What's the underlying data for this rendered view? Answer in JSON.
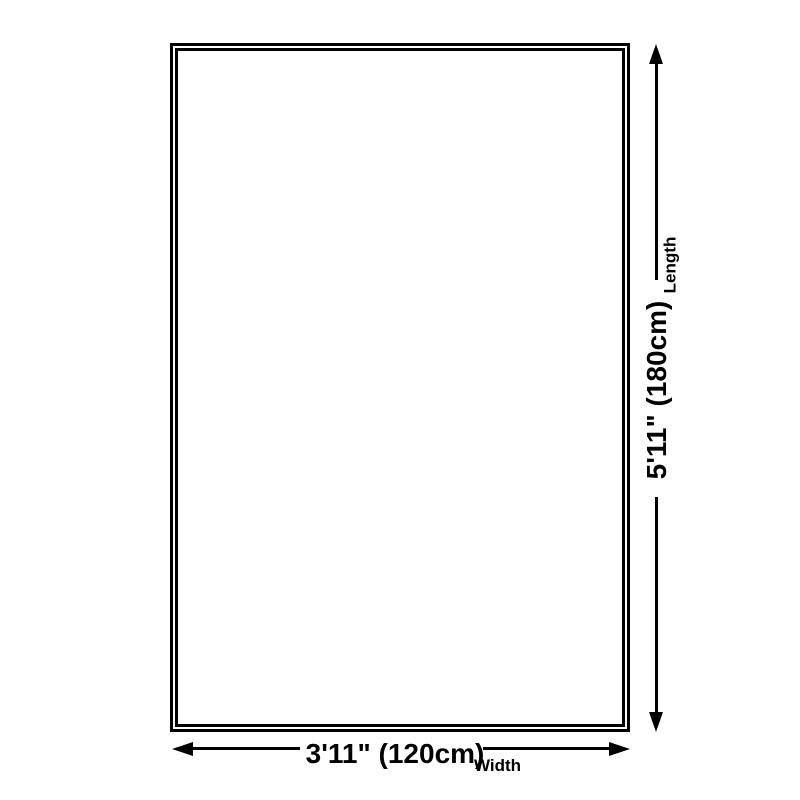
{
  "colors": {
    "bg": "#ffffff",
    "line": "#000000",
    "text": "#000000"
  },
  "diagram": {
    "type": "product-size-diagram",
    "length": {
      "value": "5'11\" (180cm)",
      "label": "Length"
    },
    "width": {
      "value": "3'11\" (120cm)",
      "label": "Width"
    }
  }
}
